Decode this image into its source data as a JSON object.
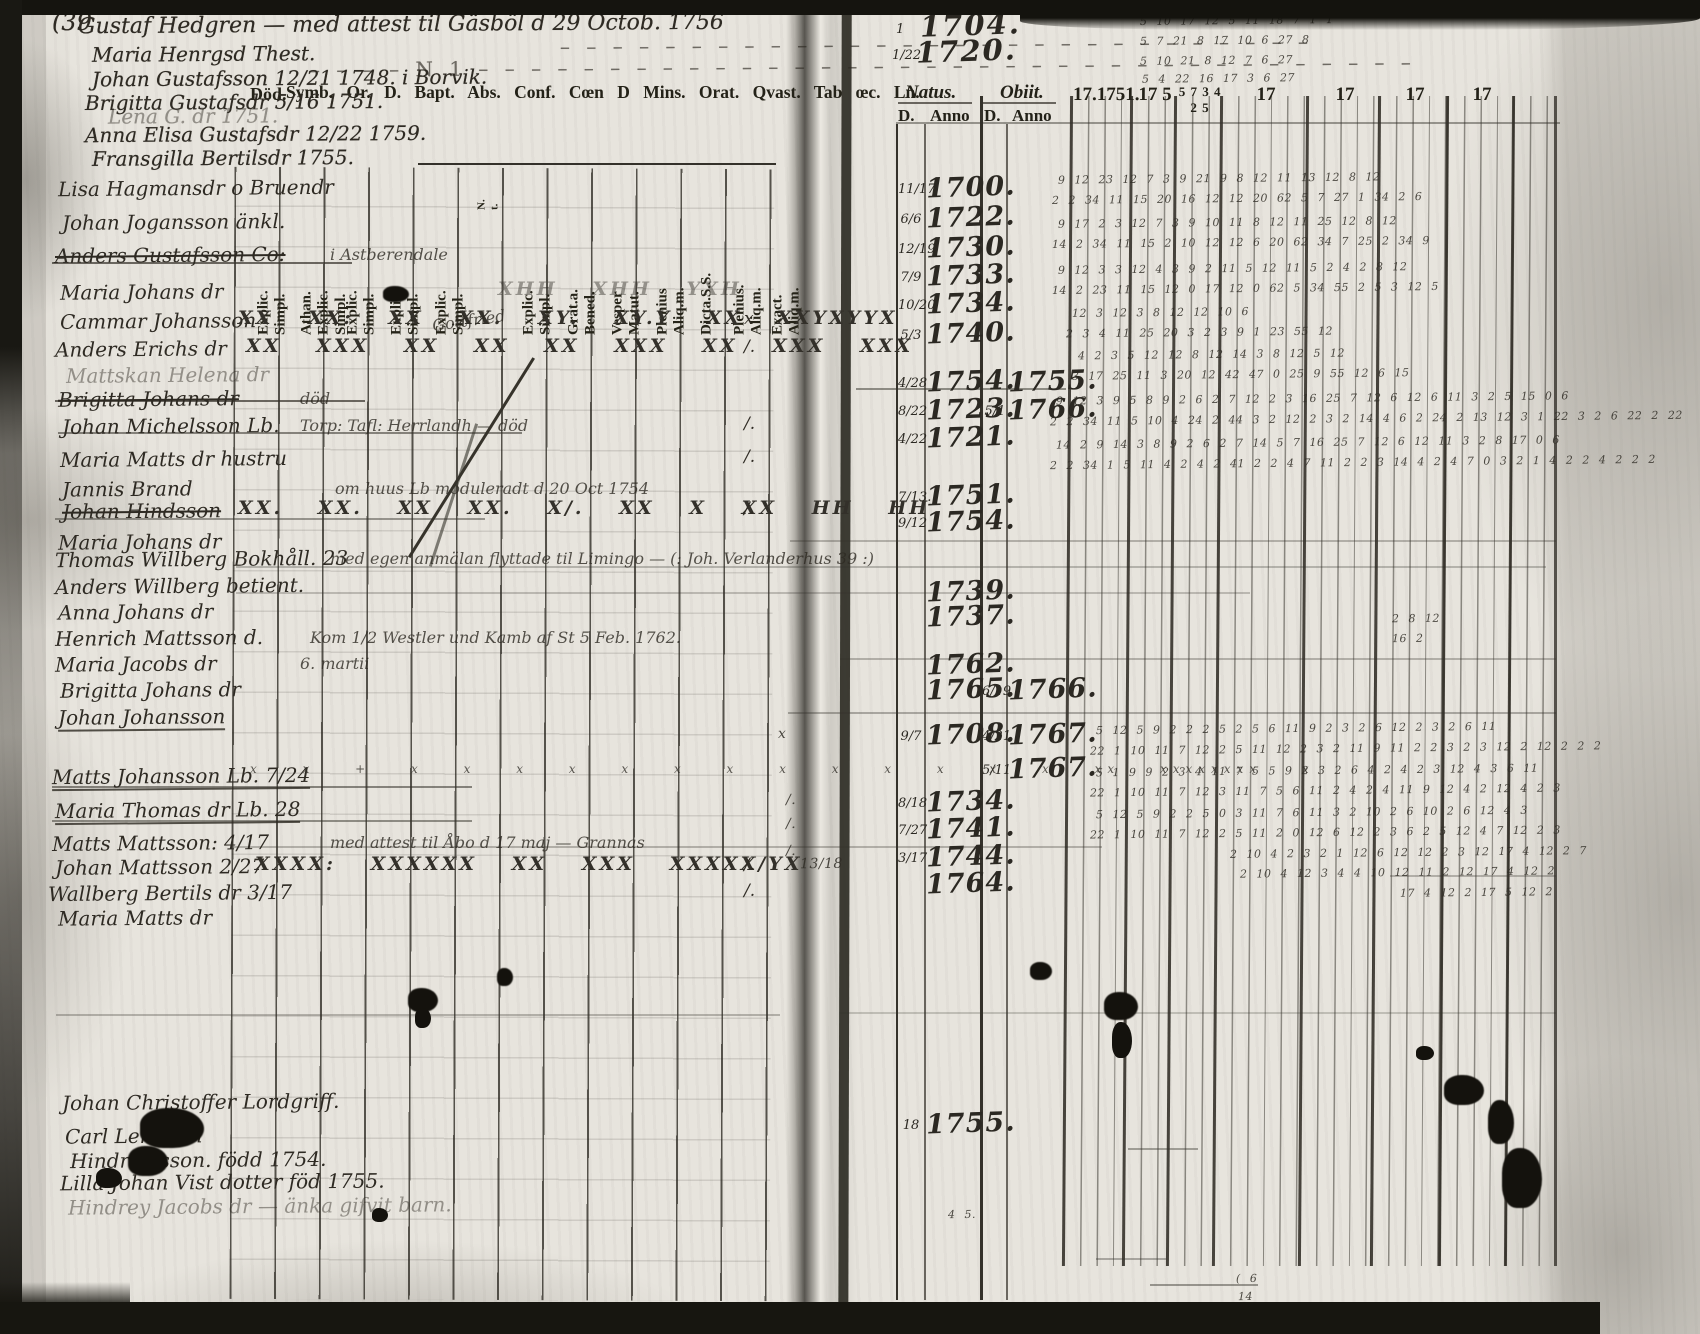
{
  "page_number": "(39",
  "left_page": {
    "printed_header": "Symb. Or. D. Bapt. Abs. Conf. Cœn D Mins. Orat. Qvast. Tab œc. Ln.",
    "died_label": "Död.",
    "column_labels": [
      {
        "x": 238,
        "label": "Explic.\nSimpl."
      },
      {
        "x": 281,
        "label": "Athan.\nExplic.\nSimpl."
      },
      {
        "x": 327,
        "label": "Explic.\nSimpl."
      },
      {
        "x": 371,
        "label": "Explic.\nSimpl."
      },
      {
        "x": 416,
        "label": "Explic.\nSimpl."
      },
      {
        "x": 463,
        "label": "N.\nt.",
        "cls": "tiny"
      },
      {
        "x": 503,
        "label": "Explic.\nSimpl."
      },
      {
        "x": 548,
        "label": "Grat.a.\nBened."
      },
      {
        "x": 592,
        "label": "Vesper\nMatut."
      },
      {
        "x": 637,
        "label": "Plenius\nAliq.m."
      },
      {
        "x": 681,
        "label": "Dicta.S.S."
      },
      {
        "x": 714,
        "label": "Plenius.\nAliq.m."
      },
      {
        "x": 752,
        "label": "Exact.\nAliq.m."
      }
    ],
    "rows": [
      {
        "y": 176,
        "name": "Lisa Hagmansdr o Bruendr",
        "name_x": 58
      },
      {
        "y": 210,
        "name": "Johan Jogansson änkl.",
        "name_x": 62
      },
      {
        "y": 243,
        "name": "Anders Gustafsson Co:",
        "name_x": 55,
        "cls": "strike",
        "note": "i Astberendale",
        "note_x": 330
      },
      {
        "y": 280,
        "name": "Maria Johans dr",
        "name_x": 60,
        "marks": "XHH XHH YXH",
        "marks_x": 498,
        "marks_cls": "faint"
      },
      {
        "y": 309,
        "name": "Cammar Johansson",
        "name_x": 60,
        "note": "Gottfried",
        "note_x": 432,
        "note_cls": "slant",
        "marks": "XX XX: XX XX. XY. XY.Y XX XXYXYYX",
        "marks_x": 238,
        "end": "x"
      },
      {
        "y": 337,
        "name": "Anders Erichs dr",
        "name_x": 55,
        "marks": "XX XXX XX XX XX XXX XX XXX XXX",
        "marks_x": 246,
        "end": "/."
      },
      {
        "y": 363,
        "name": "Mattskan Helena dr",
        "name_x": 66,
        "cls": "faint"
      },
      {
        "y": 387,
        "name": "Brigitta Johans dr",
        "name_x": 58,
        "cls": "strike",
        "note": "död",
        "note_x": 300
      },
      {
        "y": 414,
        "name": "Johan Michelsson Lb.",
        "name_x": 62,
        "note": "Torp: Tafl: Herrlandh — död",
        "note_x": 300,
        "end": "/."
      },
      {
        "y": 447,
        "name": "Maria Matts dr hustru",
        "name_x": 60,
        "end": "/."
      },
      {
        "y": 477,
        "name": "Jannis Brand",
        "name_x": 62,
        "note": "om huus Lb moduleradt d 20 Oct 1754",
        "note_x": 335,
        "note_cls": "xfaint small"
      },
      {
        "y": 499,
        "name": "Johan Hindsson",
        "name_x": 62,
        "cls": "strike",
        "marks": "XX. XX. XX XX. X/. XX X XX HH HH",
        "marks_x": 238,
        "end": "/."
      },
      {
        "y": 530,
        "name": "Maria Johans dr",
        "name_x": 58
      },
      {
        "y": 547,
        "name": "Thomas Willberg Bokhåll. 23",
        "name_x": 55,
        "note": "med egen anmälan flyttade til Limingo — (: Joh. Verlanderhus 39 :)",
        "note_x": 330,
        "note_cls": "xfaint"
      },
      {
        "y": 574,
        "name": "Anders Willberg betient.",
        "name_x": 55
      },
      {
        "y": 600,
        "name": "Anna Johans dr",
        "name_x": 58
      },
      {
        "y": 626,
        "name": "Henrich Mattsson d.",
        "name_x": 55,
        "note": "Kom 1/2 Westler und Kamb af St 5 Feb. 1762.",
        "note_x": 310,
        "note_cls": "faint"
      },
      {
        "y": 652,
        "name": "Maria Jacobs dr",
        "name_x": 55,
        "note": "6. martii",
        "note_x": 300,
        "note_cls": "faint"
      },
      {
        "y": 678,
        "name": "Brigitta Johans dr",
        "name_x": 60
      },
      {
        "y": 705,
        "name": "Johan Johansson",
        "name_x": 58,
        "cls": "underline"
      },
      {
        "y": 764,
        "name": "Matts Johansson Lb. 7/24",
        "name_x": 52,
        "cls": "underline",
        "marks": "x x + x x x x x  x x  x x  x x  x x  xx xxxxxxxx x",
        "marks_x": 250,
        "marks_cls": "xsmall"
      },
      {
        "y": 798,
        "name": "Maria Thomas dr Lb. 28",
        "name_x": 55,
        "cls": "underline"
      },
      {
        "y": 831,
        "name": "Matts Mattsson: 4/17",
        "name_x": 52,
        "note": "med attest til Åbo d 17 maj — Grannas",
        "note_x": 330,
        "note_cls": "xfaint"
      },
      {
        "y": 855,
        "name": "Johan Mattsson 2/27",
        "name_x": 55,
        "marks": "XXXX: XXXXXX XX XXX XXXXX/YX",
        "marks_x": 255,
        "end": "/."
      },
      {
        "y": 881,
        "name": "Wallberg Bertils dr 3/17",
        "name_x": 48,
        "end": "/."
      },
      {
        "y": 906,
        "name": "Maria Matts dr",
        "name_x": 58
      },
      {
        "y": 1090,
        "name": "Johan Christoffer Lordgriff.",
        "name_x": 62
      },
      {
        "y": 1124,
        "name": "Carl Lemman",
        "name_x": 65
      },
      {
        "y": 1148,
        "name": "Hindrichsson. född 1754.",
        "name_x": 70
      },
      {
        "y": 1170,
        "name": "Lilla Johan Vist dotter föd 1755.",
        "name_x": 60
      },
      {
        "y": 1194,
        "name": "Hindrey Jacobs dr — änka gifvit barn.",
        "name_x": 68,
        "cls": "faint"
      }
    ]
  },
  "annotations": [
    {
      "x": 78,
      "y": 12,
      "text": "Gustaf Hedgren — med attest til Gäsböl d 29 Octob. 1756",
      "cls": "a-lg"
    },
    {
      "x": 560,
      "y": 32,
      "text": "– – – – – – – – – – – – – – – – – – – – – – – – – – – – –",
      "cls": "dashes"
    },
    {
      "x": 92,
      "y": 42,
      "text": "Maria Henrgsd Thest."
    },
    {
      "x": 310,
      "y": 54,
      "text": "– – – –  N 1  – – – – – – – – – – – – – – – – – – – – – – – – – – – – – – – – – – – –",
      "cls": "dashes"
    },
    {
      "x": 92,
      "y": 66,
      "text": "Johan Gustafsson 12/21 1748.  i Borvik."
    },
    {
      "x": 85,
      "y": 90,
      "text": "Brigitta Gustafsdr 5/16 1751."
    },
    {
      "x": 108,
      "y": 104,
      "text": "Lena G. dr 1751.",
      "cls": "faint"
    },
    {
      "x": 85,
      "y": 122,
      "text": "Anna Elisa Gustafsdr 12/22 1759."
    },
    {
      "x": 92,
      "y": 146,
      "text": "Fransgilla Bertilsdr 1755."
    }
  ],
  "right_page": {
    "natus_header": "Natus.",
    "obiit_header": "Obiit.",
    "day_header": "D.",
    "anno_header": "Anno",
    "year_groups": [
      {
        "x": 1066,
        "w": 60,
        "label": "17.1751."
      },
      {
        "x": 1126,
        "w": 44,
        "label": "17 5"
      },
      {
        "x": 1170,
        "w": 46,
        "label": "5 7  3 4 2 5",
        "cls": "gsmall"
      },
      {
        "x": 1216,
        "w": 86,
        "label": "17"
      },
      {
        "x": 1302,
        "w": 72,
        "label": "17"
      },
      {
        "x": 1374,
        "w": 68,
        "label": "17"
      },
      {
        "x": 1442,
        "w": 66,
        "label": "17"
      },
      {
        "x": 1508,
        "w": 46,
        "label": ""
      }
    ],
    "top_dates": [
      {
        "x": 900,
        "y": 14,
        "d": "1",
        "year": "1704."
      },
      {
        "x": 896,
        "y": 40,
        "d": "1/22",
        "year": "1720."
      }
    ],
    "entries": [
      {
        "y": 176,
        "nd": "11/17",
        "ny": "1700."
      },
      {
        "y": 206,
        "nd": "6/6",
        "ny": "1722."
      },
      {
        "y": 236,
        "nd": "12/19",
        "ny": "1730."
      },
      {
        "y": 264,
        "nd": "7/9",
        "ny": "1733."
      },
      {
        "y": 292,
        "nd": "10/20",
        "ny": "1734."
      },
      {
        "y": 322,
        "nd": "5/3",
        "ny": "1740."
      },
      {
        "y": 370,
        "nd": "4/28",
        "ny": "1754.",
        "oy": "1755."
      },
      {
        "y": 398,
        "nd": "8/22",
        "ny": "1723.",
        "od": "5/1",
        "oy": "1766."
      },
      {
        "y": 426,
        "nd": "4/22",
        "ny": "1721."
      },
      {
        "y": 484,
        "nd": "7/13.",
        "ny": "1751."
      },
      {
        "y": 510,
        "nd": "9/12",
        "ny": "1754."
      },
      {
        "y": 580,
        "ny": "1739."
      },
      {
        "y": 605,
        "ny": "1737."
      },
      {
        "y": 653,
        "ny": "1762."
      },
      {
        "y": 678,
        "ny": "1765.",
        "od": "6/19",
        "oy": "1766."
      },
      {
        "y": 723,
        "nd": "9/7",
        "ny": "1708.",
        "od": "4/21",
        "oy": "1767."
      },
      {
        "y": 757,
        "od": "5/11",
        "oy": "1767."
      },
      {
        "y": 790,
        "nd": "8/18",
        "ny": "1734."
      },
      {
        "y": 817,
        "nd": "7/27",
        "ny": "1741."
      },
      {
        "y": 845,
        "nd": "3/17",
        "ny": "1744."
      },
      {
        "y": 872,
        "ny": "1764."
      },
      {
        "y": 1112,
        "nd": "18",
        "ny": "1755."
      }
    ],
    "scribbles": [
      {
        "x": 1140,
        "y": 14,
        "text": "5 10   17 12 5   11   18 7 1   1"
      },
      {
        "x": 1140,
        "y": 34,
        "text": "5 7   21 8 17   10   6 27   8"
      },
      {
        "x": 1140,
        "y": 54,
        "text": "5 10   21 8 12   7 6 27"
      },
      {
        "x": 1142,
        "y": 72,
        "text": "5 4   22 16 17   3 6 27"
      },
      {
        "x": 1058,
        "y": 172,
        "text": "9 12 23   12 7 3 9 21 9 8 12   11 13   12    8 12"
      },
      {
        "x": 1052,
        "y": 192,
        "text": "2 2 34 11 15   20 16 12 12 20 62 5 7 27 1   34 2 6"
      },
      {
        "x": 1058,
        "y": 216,
        "text": "9 17 2 3   12 7 3 9 10 11 8 12   11 25    12 8 12"
      },
      {
        "x": 1052,
        "y": 236,
        "text": "14 2 34 11 15   2 10 12 12 6 20 62 34 7 25   2 34 9"
      },
      {
        "x": 1058,
        "y": 262,
        "text": "9 12 3 3 12   4 3 9 2 11 5 12 11 5 2    4 2 8 12"
      },
      {
        "x": 1052,
        "y": 282,
        "text": "14 2 23 11 15   12 0 17 12 0 62 5 34 55   2 5 3 12 5"
      },
      {
        "x": 1072,
        "y": 306,
        "text": "12 3   12 3 8 12 12 10    6"
      },
      {
        "x": 1066,
        "y": 326,
        "text": "2 3 4 11 25 20   3 2 3 9 1 23 55    12"
      },
      {
        "x": 1078,
        "y": 348,
        "text": "4 2   3 5 12 12 8 12 14 3    8 12 5 12"
      },
      {
        "x": 1072,
        "y": 368,
        "text": "3 17   25 11 3 20 12 42 47 0 25   9 55 12 6 15"
      },
      {
        "x": 1056,
        "y": 392,
        "text": "9 12 3 9   5 8 9 2 6   2 7 12 2 3    16 25 7 12 6 12 6 11 3    2 5    15 0 6"
      },
      {
        "x": 1050,
        "y": 412,
        "text": "2 2 34 11  5 10 4 24 2 44  3 2 12 2 3   2 14 4 6 2 24 2 13 12 3 1 22   3 2   6 22 2 22"
      },
      {
        "x": 1056,
        "y": 436,
        "text": "14 2 9   14 3 8 9 2 6   2 7 14 5 7    16 25 7 12 6 12 11 3   2 8    17 0 6"
      },
      {
        "x": 1050,
        "y": 456,
        "text": "2 2 34 1  5 11 4 2 4 2 41  2 2 4 7 11 2   2 3 14 4 2 4 7 0 3 2 1 4 2   2 4 2   2 2"
      },
      {
        "x": 1392,
        "y": 612,
        "text": "2 8 12"
      },
      {
        "x": 1392,
        "y": 632,
        "text": "16 2"
      },
      {
        "x": 1096,
        "y": 722,
        "text": "5 12 5 9 2 2    2 5 2   5 6 11   9 2 3 2 6   12 2 3 2   6 11"
      },
      {
        "x": 1090,
        "y": 742,
        "text": "22 1 10 11 7 12   2 5 11   12 2 3 2 11 9   11 2 2 3 2 3   12 2   12 2 2 2"
      },
      {
        "x": 1096,
        "y": 764,
        "text": "5 1 9 9 2 3   4 11 7 5 5   9 2 3 2 6   4 2 4 2 3   12 4 3   6 11"
      },
      {
        "x": 1090,
        "y": 784,
        "text": "22 1 10 11 7 12   3 11 7 5 6   11 2 4 2 4 11 9   12 4 2   12 4 2 3"
      },
      {
        "x": 1096,
        "y": 806,
        "text": "5 12 5 9 2 2   5 0 3 11 7 6   11 3 2 10 2 6   10 2 6 12 4 3"
      },
      {
        "x": 1090,
        "y": 826,
        "text": "22 1 10 11 7 12   2 5 11   2 0 12 6 12 2 3 6   2 5 12 4 7 12 2 3"
      },
      {
        "x": 1230,
        "y": 846,
        "text": "2 10 4 2 3 2 1 12 6 12 12 2 3 12   17 4 12 2 7"
      },
      {
        "x": 1240,
        "y": 866,
        "text": "2 10 4 12 3 4 4 10 12 11 2 12   17 4 12 2"
      },
      {
        "x": 1400,
        "y": 886,
        "text": "17 4 12 2   17 5 12 2"
      },
      {
        "x": 948,
        "y": 1208,
        "text": "4 5."
      },
      {
        "x": 1236,
        "y": 1272,
        "text": "( 6"
      },
      {
        "x": 1238,
        "y": 1290,
        "text": "14"
      },
      {
        "x": 778,
        "y": 726,
        "text": "x",
        "cls": "gmark"
      },
      {
        "x": 786,
        "y": 792,
        "text": "/.",
        "cls": "gmark"
      },
      {
        "x": 786,
        "y": 816,
        "text": "/.",
        "cls": "gmark"
      },
      {
        "x": 786,
        "y": 843,
        "text": "/.",
        "cls": "gmark"
      },
      {
        "x": 800,
        "y": 856,
        "text": "13/18",
        "cls": "gmark"
      }
    ]
  }
}
